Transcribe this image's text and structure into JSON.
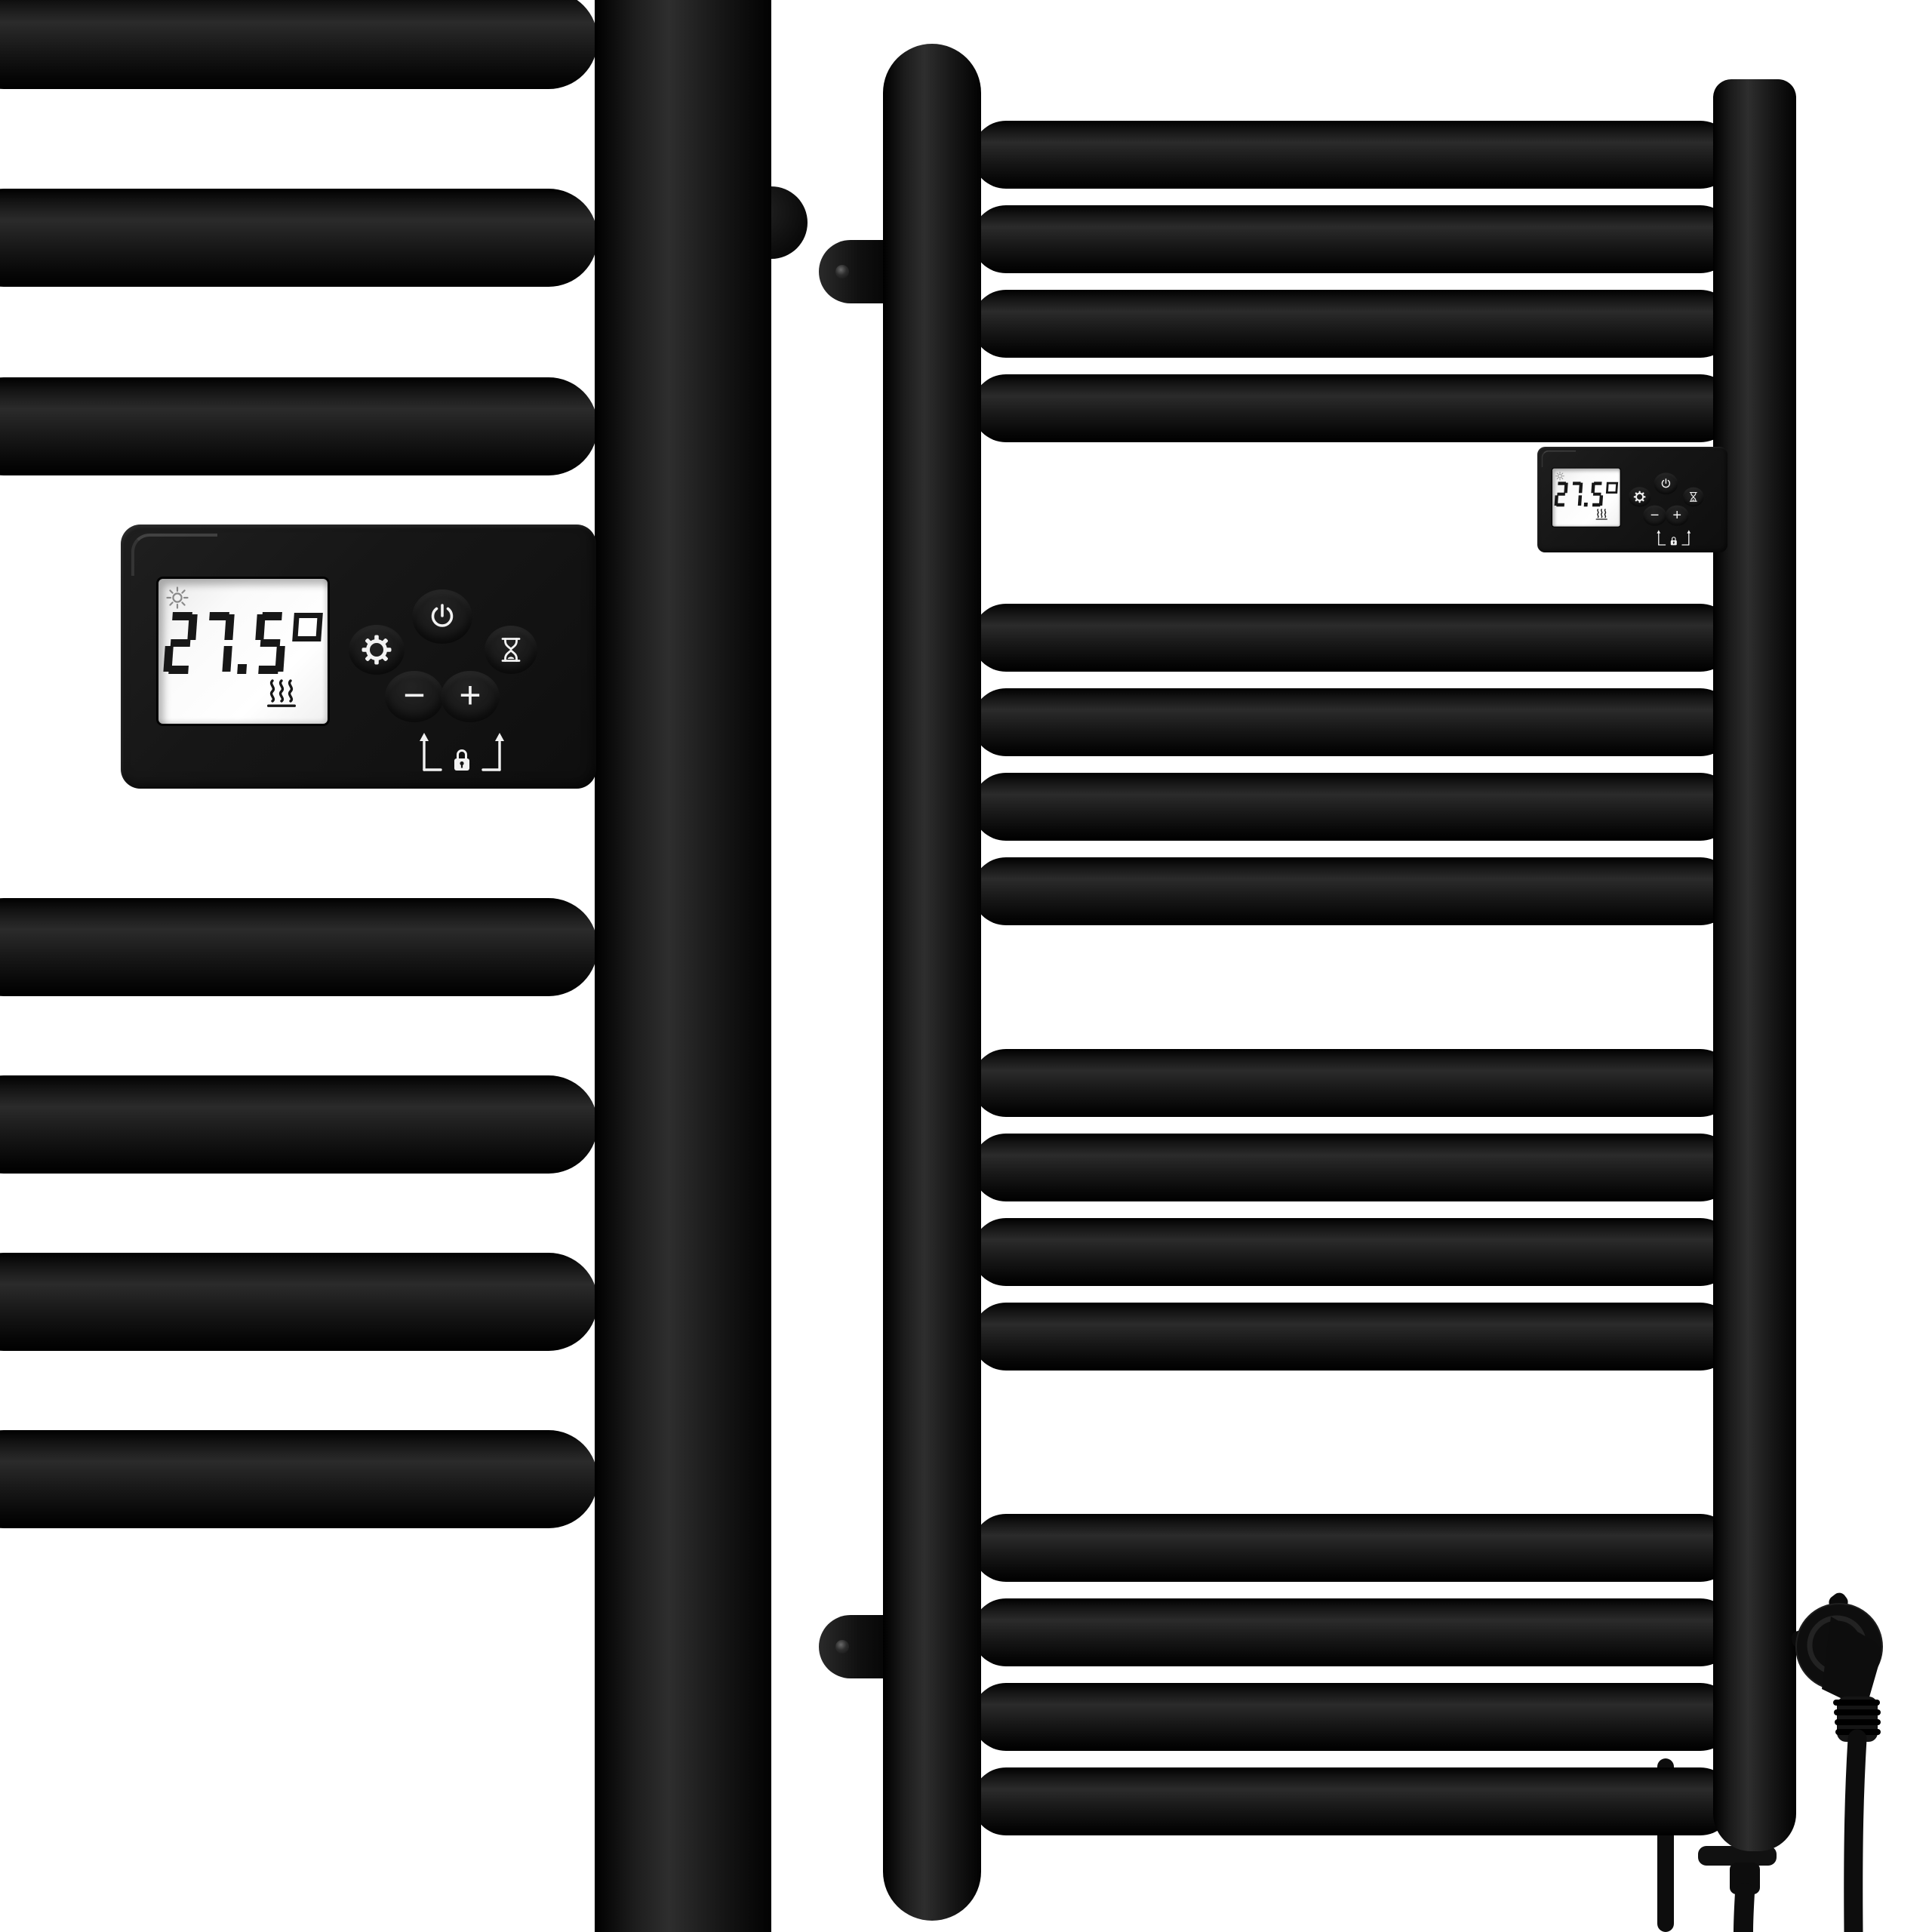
{
  "scene": {
    "description": "black electric heated towel rail radiator with digital thermostat, close-up view and full view",
    "background_color": "#ffffff"
  },
  "controller": {
    "display": {
      "temperature": "27.5°",
      "mode_icon": "sun-icon",
      "heating_icon": "heat-waves-icon"
    },
    "buttons": [
      {
        "name": "settings",
        "icon": "gear-icon",
        "label": ""
      },
      {
        "name": "power",
        "icon": "power-icon",
        "label": ""
      },
      {
        "name": "timer",
        "icon": "hourglass-icon",
        "label": ""
      },
      {
        "name": "decrease",
        "icon": "",
        "label": "−"
      },
      {
        "name": "increase",
        "icon": "",
        "label": "+"
      }
    ],
    "lock_hint_icon": "lock-icon"
  },
  "colors": {
    "background": "#ffffff",
    "radiator_black": "#0f0f0f",
    "controller_body": "#161616",
    "lcd_background": "#f7f7f7",
    "lcd_text": "#171717",
    "lcd_mode_icon": "#8a8a8a",
    "button_glyph": "#f2f2f2",
    "cable": "#0d0d0d"
  }
}
